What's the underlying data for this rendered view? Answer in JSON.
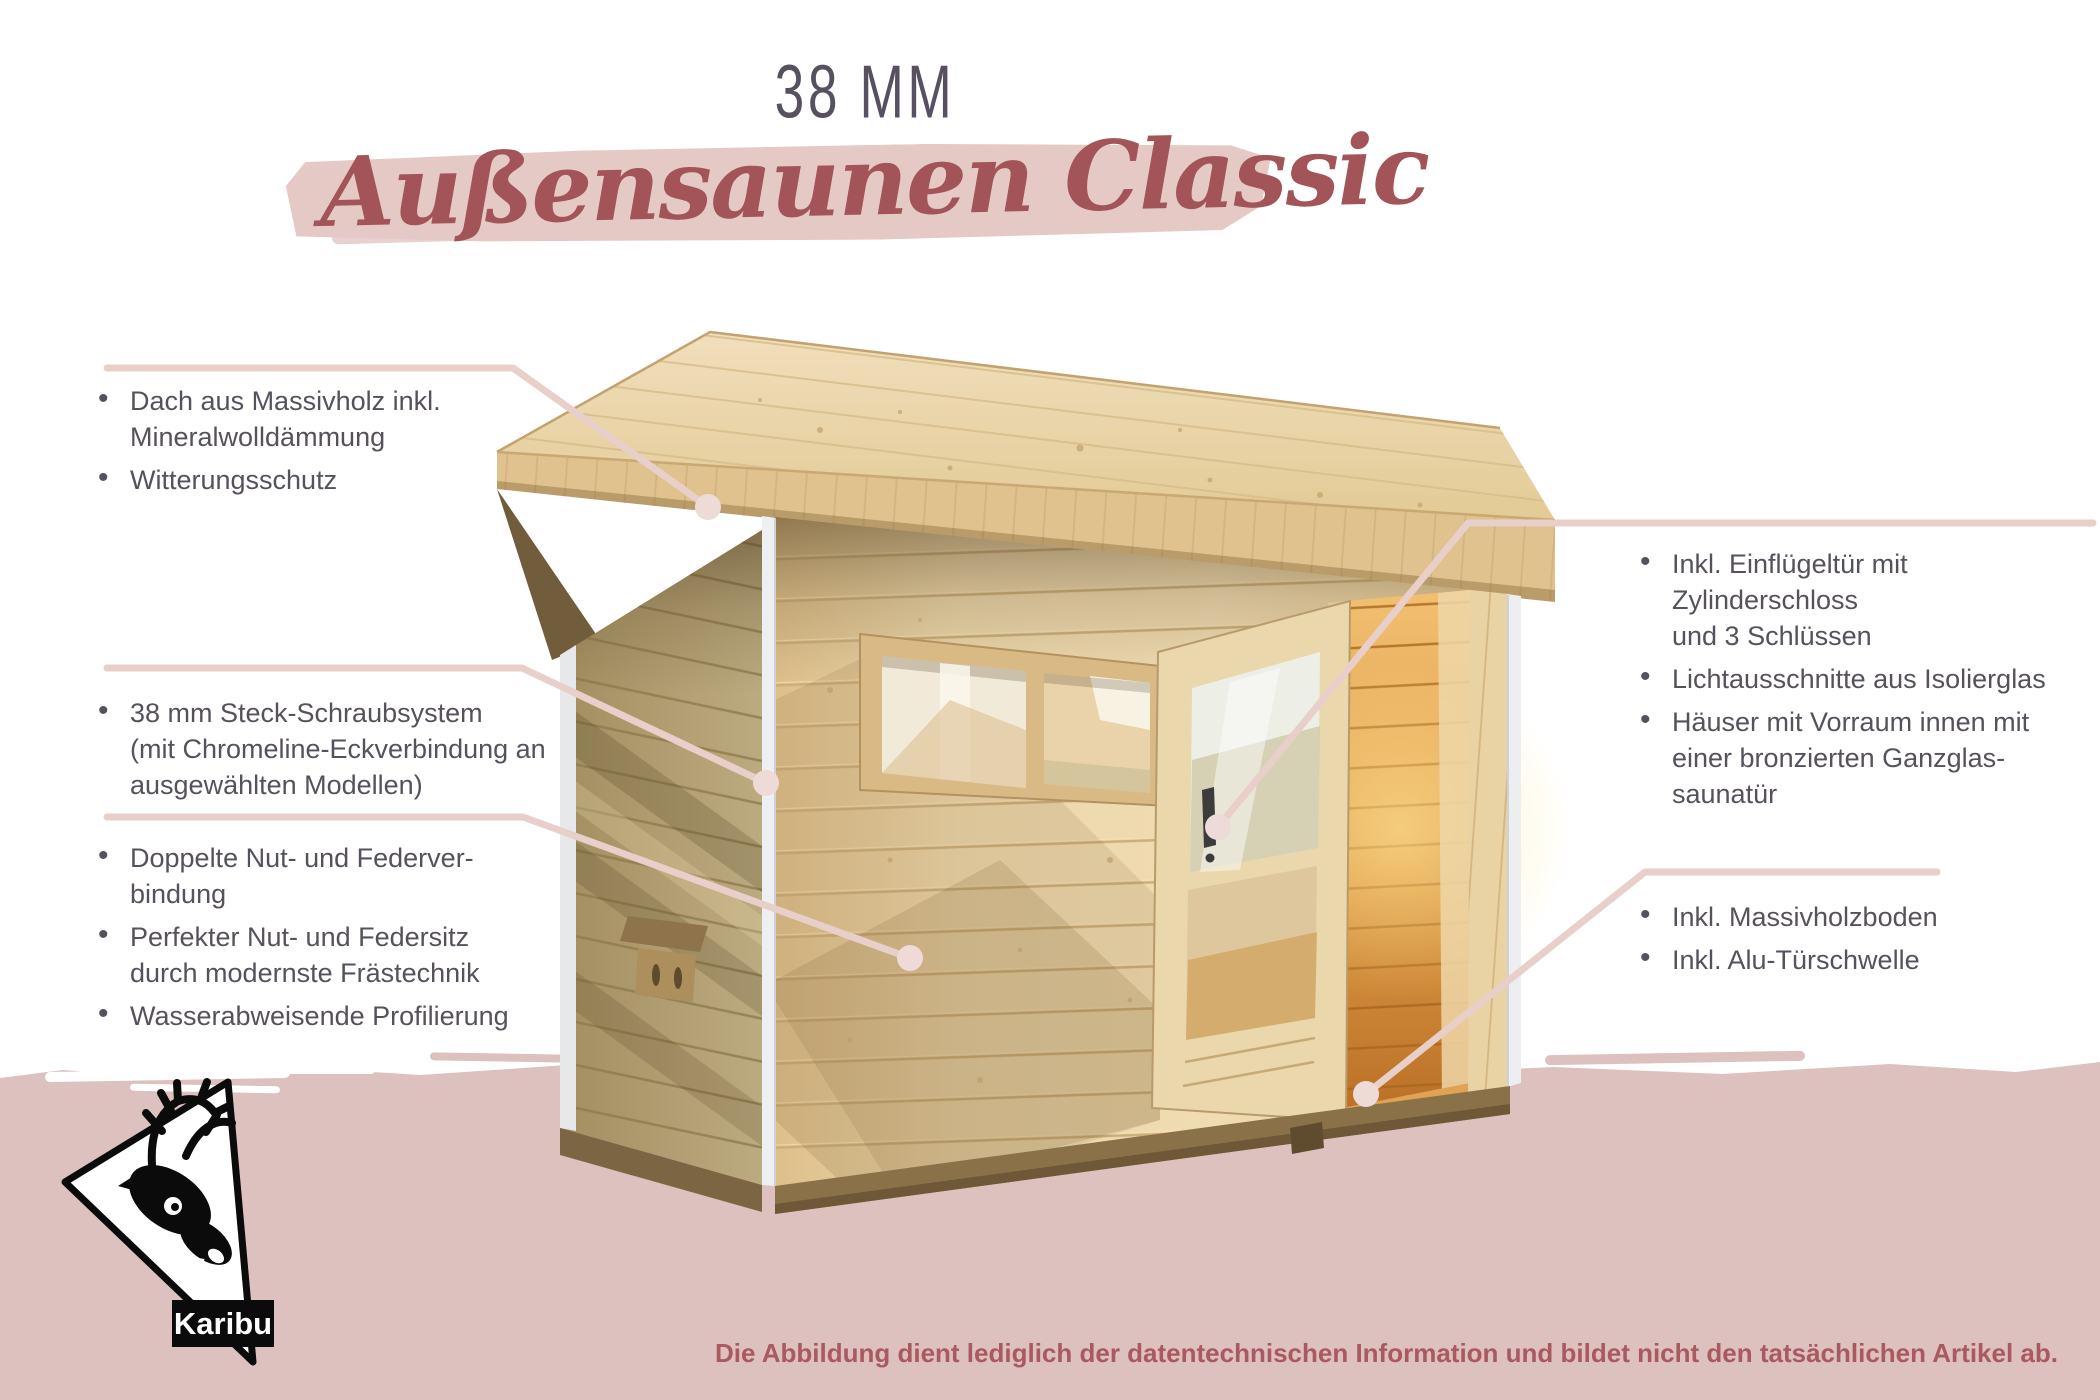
{
  "header": {
    "thickness_label": "38 MM",
    "title": "Außensaunen Classic"
  },
  "features": {
    "roof": {
      "items": [
        "Dach aus Massivholz inkl.\nMineralwolldämmung",
        "Witterungsschutz"
      ]
    },
    "walls": {
      "items": [
        "38 mm Steck-Schraubsystem\n(mit Chromeline-Eckverbindung an\nausgewählten Modellen)"
      ]
    },
    "joinery": {
      "items": [
        "Doppelte Nut- und Federver-\nbindung",
        "Perfekter Nut- und Federsitz\ndurch modernste Frästechnik",
        "Wasserabweisende Profilierung"
      ]
    },
    "door": {
      "items": [
        "Inkl. Einflügeltür mit Zylinderschloss\nund 3 Schlüssen",
        "Lichtausschnitte aus Isolierglas",
        "Häuser mit Vorraum innen mit\neiner bronzierten Ganzglas-\nsaunatür"
      ]
    },
    "floor": {
      "items": [
        "Inkl. Massivholzboden",
        "Inkl. Alu-Türschwelle"
      ]
    }
  },
  "footer": {
    "disclaimer": "Die Abbildung dient lediglich der datentechnischen Information und bildet nicht den tatsächlichen Artikel ab."
  },
  "logo": {
    "brand": "Karibu"
  },
  "colors": {
    "headline": "#575060",
    "title": "#a25458",
    "body_text": "#56515d",
    "brush": "#e4c9c5",
    "band": "#dcc1be",
    "callout_line": "#e8cfc9",
    "callout_dot": "#eedbd7",
    "disclaimer": "#a9595f"
  }
}
